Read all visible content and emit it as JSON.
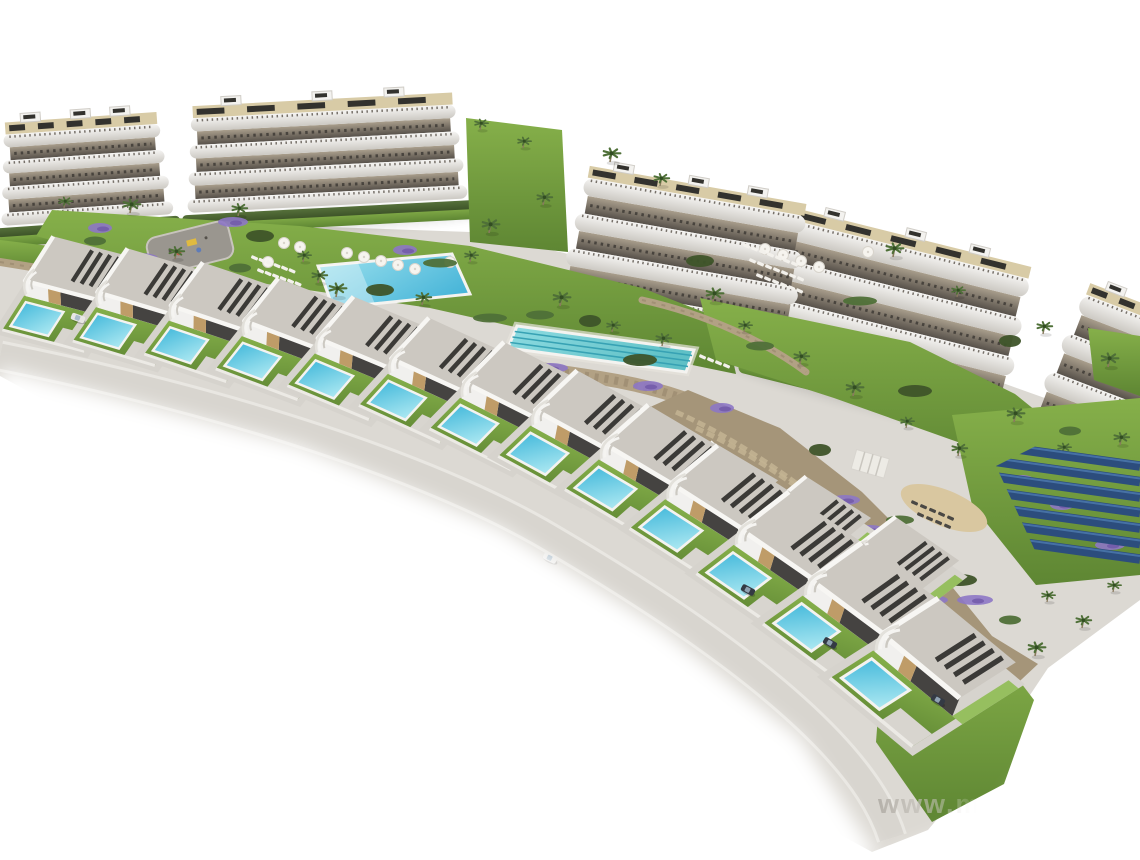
{
  "meta": {
    "description": "Aerial 3D architectural rendering of a coastal residential development: five curved white apartment blocks with terraced balconies and rooftop solar panels along the top, landscaped gardens with palms and purple shrubs, a communal swimming pool and a lap pool, a playground, two diagonal rows of detached villas each with a private turquoise pool, access roads, a stone retaining hillside and a blue solar-panel field, all fading into a white background."
  },
  "watermark": {
    "text": "www.m",
    "x": 878,
    "y": 813,
    "size": 27
  },
  "palette": {
    "bg": "#ffffff",
    "basePaving": "#dcd9d3",
    "bandTop": "#f6f5f3",
    "bandBottom": "#ccc9c3",
    "railing": "#77716a",
    "terraceTop": "#a99e8c",
    "terraceBottom": "#57514a",
    "furniture": "#3f3b36",
    "roofDeck": "#d8cba6",
    "roofPanel": "#33322e",
    "roofBox": "#f3f2ef",
    "roofBoxEdge": "#d0cdc7",
    "hedgeTop": "#55703a",
    "hedgeBottom": "#3e5429",
    "grassTop": "#86b04a",
    "grassBottom": "#5e8633",
    "grassBright": "#8fbc53",
    "palmGreen": "#4f7038",
    "palmDark": "#324d22",
    "trunk": "#8a7a5e",
    "purple": "#8d77c5",
    "purpleDark": "#6f57a8",
    "poolMainA": "#49b6d9",
    "poolMainB": "#9fe2ee",
    "lapA": "#5fc0c6",
    "lapB": "#8fdce2",
    "lane": "#37a2b4",
    "villaPoolA": "#37b3d8",
    "villaPoolB": "#aee9f2",
    "poolRim": "#f4f3f0",
    "road": "#d8d5cf",
    "roadEdge": "#e9e7e2",
    "villaRoof": "#ccc8c1",
    "villaRoofEdge": "#f7f6f3",
    "villaWall": "#f1f0ee",
    "villaSide": "#dddad4",
    "porch": "#454341",
    "tanWall": "#bf9c68",
    "slat": "#3b3a37",
    "pad": "#d6d3cd",
    "stone": "#b2a184",
    "stoneDark": "#8f8066",
    "hillside": "#a59579",
    "terraceLine": "#c3b493",
    "solar": "#2c4d7d",
    "solarHi": "#4e7bb0",
    "sand": "#d9c7a0",
    "playground": "#9a968f",
    "playBorder": "#c8c4bd",
    "playYellow": "#e0ba40",
    "playRed": "#bc5a4a",
    "playBlue": "#5f7cb8",
    "loungerLight": "#f3f1ec",
    "loungerDark": "#4a4844",
    "umbrella": "#f6f4ef",
    "umbrellaEdge": "#d8d4cc",
    "carLight": "#e8e7e4",
    "carDark": "#343a44",
    "shadow": "#000000"
  },
  "scene": {
    "basePad": [
      [
        0,
        238
      ],
      [
        190,
        222
      ],
      [
        470,
        232
      ],
      [
        560,
        252
      ],
      [
        760,
        300
      ],
      [
        1000,
        382
      ],
      [
        1140,
        432
      ],
      [
        1140,
        600
      ],
      [
        1048,
        668
      ],
      [
        988,
        758
      ],
      [
        928,
        830
      ],
      [
        872,
        852
      ],
      [
        0,
        376
      ]
    ],
    "buildings": [
      {
        "x": 2,
        "y": 226,
        "w": 172,
        "angle": -4,
        "fh": 26
      },
      {
        "x": 188,
        "y": 213,
        "w": 280,
        "angle": -3,
        "fh": 27
      },
      {
        "x": 556,
        "y": 300,
        "w": 240,
        "angle": 10,
        "fh": 36
      },
      {
        "x": 752,
        "y": 354,
        "w": 260,
        "angle": 14,
        "fh": 40
      },
      {
        "x": 1024,
        "y": 428,
        "w": 175,
        "angle": 21,
        "fh": 42
      }
    ],
    "greens": [
      [
        [
          52,
          210
        ],
        [
          300,
          226
        ],
        [
          470,
          246
        ],
        [
          642,
          288
        ],
        [
          724,
          320
        ],
        [
          736,
          374
        ],
        [
          600,
          346
        ],
        [
          430,
          308
        ],
        [
          240,
          280
        ],
        [
          110,
          256
        ],
        [
          36,
          236
        ]
      ],
      [
        [
          700,
          298
        ],
        [
          910,
          342
        ],
        [
          1015,
          394
        ],
        [
          1062,
          432
        ],
        [
          1050,
          474
        ],
        [
          952,
          440
        ],
        [
          834,
          398
        ],
        [
          716,
          360
        ]
      ],
      [
        [
          952,
          415
        ],
        [
          1140,
          398
        ],
        [
          1140,
          575
        ],
        [
          1036,
          585
        ],
        [
          972,
          505
        ]
      ],
      [
        [
          884,
          636
        ],
        [
          1002,
          658
        ],
        [
          1034,
          700
        ],
        [
          1004,
          784
        ],
        [
          932,
          822
        ],
        [
          876,
          742
        ]
      ],
      [
        [
          466,
          118
        ],
        [
          562,
          130
        ],
        [
          568,
          252
        ],
        [
          470,
          242
        ]
      ],
      [
        [
          0,
          240
        ],
        [
          66,
          248
        ],
        [
          96,
          260
        ],
        [
          62,
          272
        ],
        [
          0,
          262
        ]
      ],
      [
        [
          1088,
          328
        ],
        [
          1140,
          336
        ],
        [
          1140,
          396
        ],
        [
          1094,
          380
        ]
      ]
    ],
    "walls": {
      "left": "M 0 262 C 62 272, 124 282, 162 291",
      "main": "M 30 298 C 210 324, 420 350, 600 378 C 690 392, 756 424, 826 476 C 884 522, 942 582, 990 648",
      "mid": "M 642 300 C 706 314, 766 342, 806 372"
    },
    "hillside": {
      "poly": [
        [
          688,
          390
        ],
        [
          780,
          428
        ],
        [
          862,
          492
        ],
        [
          932,
          562
        ],
        [
          992,
          636
        ],
        [
          1038,
          664
        ],
        [
          1006,
          694
        ],
        [
          938,
          650
        ],
        [
          856,
          584
        ],
        [
          776,
          504
        ],
        [
          698,
          440
        ],
        [
          648,
          408
        ]
      ],
      "terraces": [
        "M 696 428 C 780 466, 858 530, 936 602",
        "M 676 412 C 766 452, 852 522, 950 614"
      ]
    },
    "pools": {
      "main": [
        [
          318,
          266
        ],
        [
          452,
          254
        ],
        [
          470,
          294
        ],
        [
          333,
          308
        ]
      ],
      "lap": [
        [
          517,
          326
        ],
        [
          694,
          350
        ],
        [
          686,
          372
        ],
        [
          508,
          348
        ]
      ]
    },
    "playground": {
      "x": 190,
      "y": 248,
      "rot": -14,
      "w": 84,
      "h": 38
    },
    "pergola": {
      "x": 858,
      "y": 452,
      "rot": 16
    },
    "sand": {
      "cx": 944,
      "cy": 508,
      "rx": 46,
      "ry": 18,
      "rot": 22
    },
    "solar": {
      "clip": [
        [
          996,
          466
        ],
        [
          1052,
          438
        ],
        [
          1140,
          424
        ],
        [
          1140,
          564
        ],
        [
          1044,
          570
        ]
      ],
      "rows": 7,
      "y0": 446,
      "dy": 15.5,
      "drop": 20
    },
    "umbrellas": [
      [
        347,
        253
      ],
      [
        364,
        257
      ],
      [
        381,
        261
      ],
      [
        398,
        265
      ],
      [
        415,
        269
      ],
      [
        300,
        247
      ],
      [
        284,
        243
      ],
      [
        268,
        262
      ],
      [
        765,
        249
      ],
      [
        783,
        255
      ],
      [
        801,
        261
      ],
      [
        819,
        267
      ],
      [
        868,
        252
      ],
      [
        450,
        262
      ]
    ],
    "loungerRows": [
      {
        "x": 252,
        "y": 255,
        "n": 6,
        "dx": 7.5,
        "dy": 2.6,
        "dark": false
      },
      {
        "x": 258,
        "y": 268,
        "n": 6,
        "dx": 7.5,
        "dy": 2.6,
        "dark": false
      },
      {
        "x": 744,
        "y": 243,
        "n": 7,
        "dx": 8,
        "dy": 3,
        "dark": false
      },
      {
        "x": 750,
        "y": 258,
        "n": 7,
        "dx": 8,
        "dy": 3,
        "dark": false
      },
      {
        "x": 757,
        "y": 273,
        "n": 6,
        "dx": 8,
        "dy": 3,
        "dark": false
      },
      {
        "x": 700,
        "y": 354,
        "n": 4,
        "dx": 8,
        "dy": 3,
        "dark": false
      },
      {
        "x": 912,
        "y": 500,
        "n": 5,
        "dx": 9,
        "dy": 3.8,
        "dark": true
      },
      {
        "x": 918,
        "y": 512,
        "n": 4,
        "dx": 9,
        "dy": 3.8,
        "dark": true
      }
    ],
    "palms": [
      [
        523,
        148
      ],
      [
        543,
        205
      ],
      [
        489,
        233
      ],
      [
        470,
        262
      ],
      [
        318,
        283
      ],
      [
        336,
        297
      ],
      [
        303,
        262
      ],
      [
        422,
        305
      ],
      [
        560,
        306
      ],
      [
        612,
        332
      ],
      [
        662,
        346
      ],
      [
        713,
        302
      ],
      [
        744,
        332
      ],
      [
        800,
        364
      ],
      [
        853,
        396
      ],
      [
        906,
        428
      ],
      [
        958,
        456
      ],
      [
        1014,
        422
      ],
      [
        1063,
        454
      ],
      [
        238,
        216
      ],
      [
        130,
        213
      ],
      [
        64,
        208
      ],
      [
        175,
        259
      ],
      [
        893,
        257
      ],
      [
        957,
        297
      ],
      [
        1043,
        334
      ],
      [
        1108,
        367
      ],
      [
        1047,
        602
      ],
      [
        1082,
        628
      ],
      [
        1035,
        656
      ],
      [
        1113,
        592
      ],
      [
        660,
        186
      ],
      [
        610,
        162
      ],
      [
        480,
        130
      ],
      [
        1120,
        445
      ]
    ],
    "bushes": [
      [
        95,
        241
      ],
      [
        260,
        236
      ],
      [
        440,
        263
      ],
      [
        590,
        321
      ],
      [
        760,
        346
      ],
      [
        915,
        391
      ],
      [
        1070,
        431
      ],
      [
        700,
        261
      ],
      [
        860,
        301
      ],
      [
        1010,
        341
      ],
      [
        540,
        315
      ],
      [
        640,
        360
      ],
      [
        240,
        268
      ],
      [
        380,
        290
      ],
      [
        490,
        318
      ],
      [
        820,
        450
      ],
      [
        900,
        520
      ],
      [
        960,
        580
      ],
      [
        1010,
        620
      ]
    ],
    "purples": [
      [
        100,
        228
      ],
      [
        233,
        222
      ],
      [
        550,
        368
      ],
      [
        722,
        408
      ],
      [
        845,
        500
      ],
      [
        900,
        575
      ],
      [
        1062,
        505
      ],
      [
        1110,
        545
      ],
      [
        140,
        258
      ],
      [
        405,
        250
      ],
      [
        648,
        386
      ],
      [
        975,
        600
      ],
      [
        1022,
        480
      ],
      [
        870,
        530
      ],
      [
        930,
        600
      ]
    ],
    "villasBack": [
      [
        560,
        398,
        11,
        0.9
      ],
      [
        650,
        432,
        13,
        0.9
      ],
      [
        740,
        468,
        15,
        0.92
      ],
      [
        828,
        508,
        17,
        0.92
      ]
    ],
    "villasFront": [
      [
        0,
        232,
        -3,
        0.95
      ],
      [
        72,
        245,
        -1,
        0.96
      ],
      [
        145,
        260,
        1,
        0.97
      ],
      [
        218,
        277,
        3,
        0.98
      ],
      [
        291,
        296,
        5,
        0.99
      ],
      [
        364,
        318,
        7,
        1.0
      ],
      [
        436,
        344,
        9,
        1.02
      ],
      [
        506,
        374,
        11,
        1.04
      ],
      [
        574,
        410,
        13,
        1.06
      ],
      [
        640,
        452,
        15,
        1.08
      ],
      [
        708,
        500,
        17,
        1.1
      ],
      [
        776,
        554,
        19,
        1.14
      ],
      [
        845,
        614,
        22,
        1.2
      ]
    ],
    "roads": {
      "main": "M 0 356 C 240 404, 430 470, 540 532 C 650 596, 760 668, 830 742 C 862 776, 882 806, 892 838",
      "side": "M 470 400 C 600 450, 710 520, 790 596 C 830 634, 858 668, 876 700"
    },
    "cars": [
      [
        78,
        318,
        20,
        "light"
      ],
      [
        550,
        558,
        26,
        "light"
      ],
      [
        748,
        590,
        28,
        "dark"
      ],
      [
        830,
        643,
        30,
        "dark"
      ],
      [
        938,
        700,
        30,
        "dark"
      ]
    ],
    "fades": {
      "bl": [
        [
          0,
          368
        ],
        [
          300,
          446
        ],
        [
          500,
          528
        ],
        [
          660,
          628
        ],
        [
          800,
          738
        ],
        [
          880,
          860
        ],
        [
          0,
          860
        ]
      ],
      "br": [
        [
          880,
          860
        ],
        [
          1002,
          812
        ],
        [
          1090,
          690
        ],
        [
          1140,
          618
        ],
        [
          1140,
          860
        ]
      ]
    }
  }
}
